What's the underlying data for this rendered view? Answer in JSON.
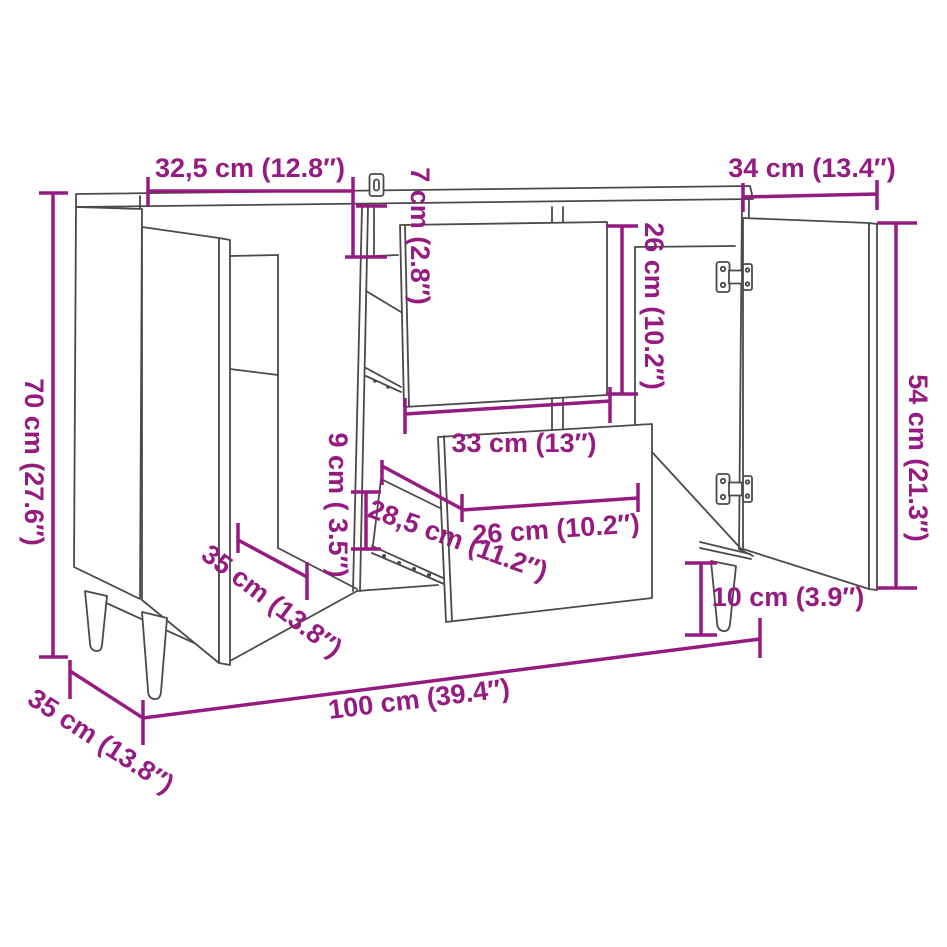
{
  "figure": {
    "kind": "furniture-dimension-diagram",
    "product": "sideboard with 2 doors and 2 drawers",
    "background_color": "#ffffff",
    "line_color": "#4a4a48",
    "dimension_color": "#951b81"
  },
  "labels": {
    "width_left_door": "32,5 cm (12.8″)",
    "height_top_rail": "7 cm (2.8″)",
    "width_right_door": "34 cm (13.4″)",
    "height_drawer_front": "26 cm (10.2″)",
    "height_right_door": "54 cm (21.3″)",
    "height_total": "70 cm (27.6″)",
    "width_drawer": "33 cm (13″)",
    "height_bottom_gap": "9 cm ( 3.5″)",
    "depth_drawer": "28,5 cm (11.2″)",
    "width_drawer_inner": "26 cm (10.2″)",
    "depth_compartment": "35 cm (13.8″)",
    "height_leg": "10 cm (3.9″)",
    "width_total": "100 cm (39.4″)",
    "depth_total": "35 cm (13.8″)"
  }
}
